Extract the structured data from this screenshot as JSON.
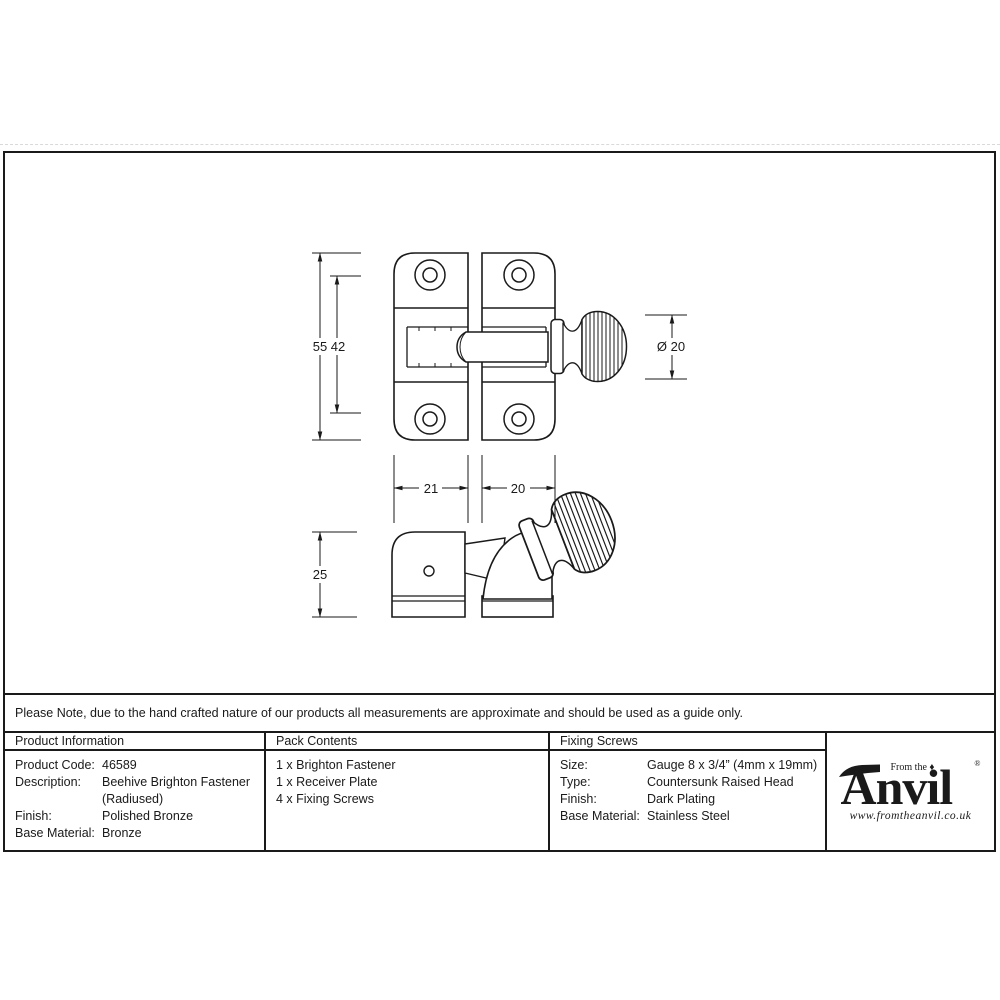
{
  "note": "Please Note, due to the hand crafted nature of our products all measurements are approximate and should be used as a guide only.",
  "drawing": {
    "dims": {
      "plate_height": "55",
      "hole_spacing": "42",
      "knob_diameter": "Ø 20",
      "left_plate_width": "21",
      "right_plate_width": "20",
      "side_height": "25"
    }
  },
  "table": {
    "product_info": {
      "header": "Product Information",
      "rows": [
        {
          "label": "Product Code:",
          "value": "46589"
        },
        {
          "label": "Description:",
          "value": "Beehive Brighton Fastener"
        },
        {
          "label": "",
          "value": "(Radiused)"
        },
        {
          "label": "Finish:",
          "value": "Polished Bronze"
        },
        {
          "label": "Base Material:",
          "value": "Bronze"
        }
      ]
    },
    "pack_contents": {
      "header": "Pack Contents",
      "items": [
        "1 x Brighton Fastener",
        "1 x Receiver Plate",
        "4 x Fixing Screws"
      ]
    },
    "fixing_screws": {
      "header": "Fixing Screws",
      "rows": [
        {
          "label": "Size:",
          "value": "Gauge 8 x 3/4” (4mm x 19mm)"
        },
        {
          "label": "Type:",
          "value": "Countersunk Raised Head"
        },
        {
          "label": "Finish:",
          "value": "Dark Plating"
        },
        {
          "label": "Base Material:",
          "value": "Stainless Steel"
        }
      ]
    }
  },
  "logo": {
    "from_the": "From the ♦",
    "name_initial": "A",
    "name_rest": "nvil",
    "registered": "®",
    "website": "www.fromtheanvil.co.uk"
  },
  "colors": {
    "ink": "#1a1a1a",
    "paper": "#ffffff",
    "dashed_edge": "#d9d9d9"
  }
}
